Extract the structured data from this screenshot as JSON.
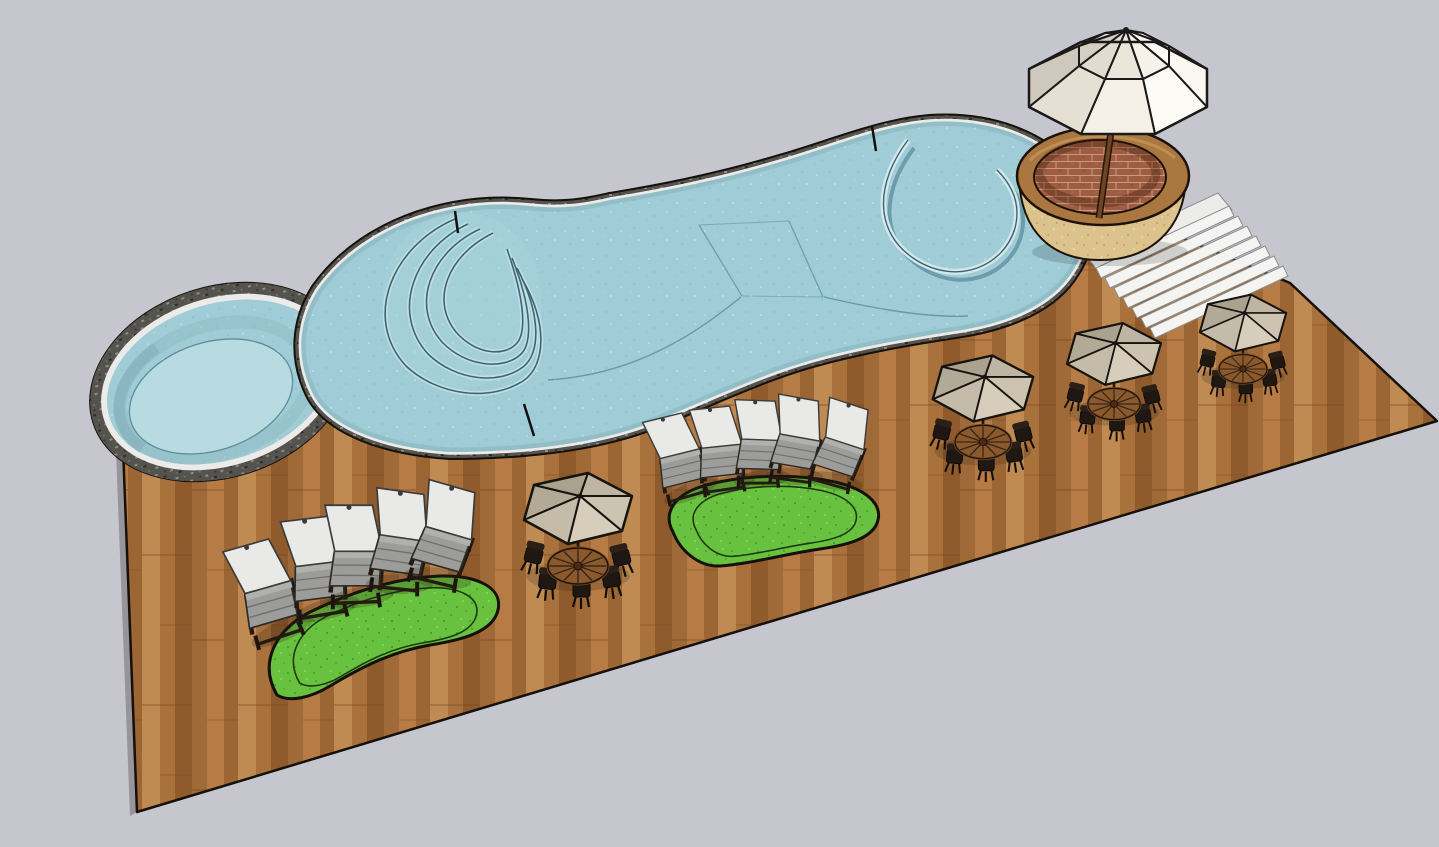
{
  "scene": {
    "kind": "3d-model-render",
    "description": "Isometric render of a freeform swimming pool with curved entry steps, an attached round spa, a wooden plank deck, two kidney-shaped grass patches, ten chaise lounges, four taupe umbrella dining sets, a brick planter with a large white market umbrella, and white concrete stairs.",
    "background_color": "#c5c6ce",
    "colors": {
      "background": "#c5c6ce",
      "deck_wood": "#ad7440",
      "deck_wood_light": "#c08b52",
      "deck_wood_dark": "#8f5a2c",
      "pool_water": "#9fccd6",
      "pool_wall_shade": "#86b3be",
      "coping_dark": "#55534e",
      "coping_band_white": "#ebebe9",
      "step_edge": "#3c6570",
      "step_highlight": "#c2dfe5",
      "spa_floor": "#b7dbe0",
      "grass": "#68c23f",
      "grass_dark": "#54a32d",
      "umbrella_taupe": "#bfb5a3",
      "umbrella_white": "#f6f1e9",
      "planter_stone": "#dcc28c",
      "planter_wood": "#a9773f",
      "brick": "#9e5c42",
      "brick_mortar": "#c99b7d",
      "stairs_white": "#f4f4f2",
      "lounge_cushion": "#e9e9e7",
      "lounge_frame": "#241a10",
      "table_wood": "#8a5a2e",
      "chair_dark": "#1f1812",
      "pole_brown": "#6e4426",
      "outline": "#15100a"
    },
    "objects": {
      "main_pool": {
        "shape": "freeform-kidney",
        "features_count": 4
      },
      "round_spa": {
        "count": 1
      },
      "wood_deck": {
        "material": "plank"
      },
      "grass_patches": {
        "count": 2
      },
      "chaise_lounges": {
        "count": 10
      },
      "umbrella_dining_sets": {
        "count": 4
      },
      "brick_planter": {
        "count": 1
      },
      "market_umbrella": {
        "count": 1
      },
      "stair_treads": {
        "count": 7
      }
    }
  }
}
